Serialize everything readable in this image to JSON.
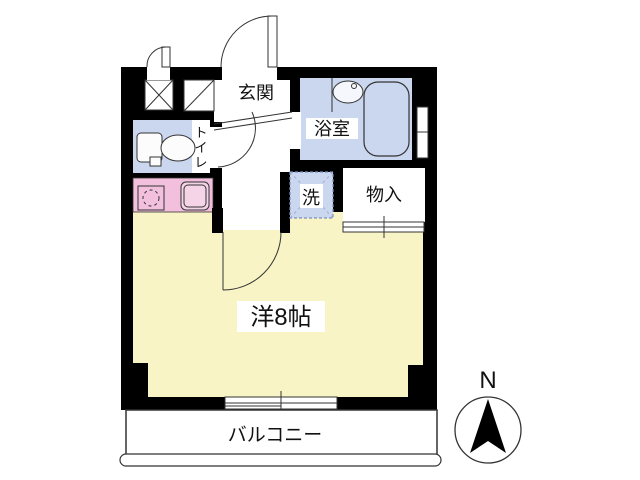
{
  "floor_plan": {
    "rooms": {
      "entrance": {
        "label": "玄関"
      },
      "bathroom": {
        "label": "浴室"
      },
      "toilet": {
        "label": "トイレ",
        "chars": [
          "ト",
          "イ",
          "レ"
        ]
      },
      "laundry": {
        "label": "洗"
      },
      "storage": {
        "label": "物入"
      },
      "main_room": {
        "label": "洋8帖"
      },
      "balcony": {
        "label": "バルコニー"
      }
    },
    "compass": {
      "north_label": "N"
    },
    "colors": {
      "wall": "#000000",
      "room_yellow": "#F8F4C5",
      "wet_area_blue": "#CBD7EE",
      "kitchen_pink": "#F2C0DC",
      "kitchen_sink_pink": "#F6D4E8",
      "fixture_white": "#FCFCFC",
      "dashed_blue": "#7A8FC0",
      "line": "#333333"
    }
  }
}
